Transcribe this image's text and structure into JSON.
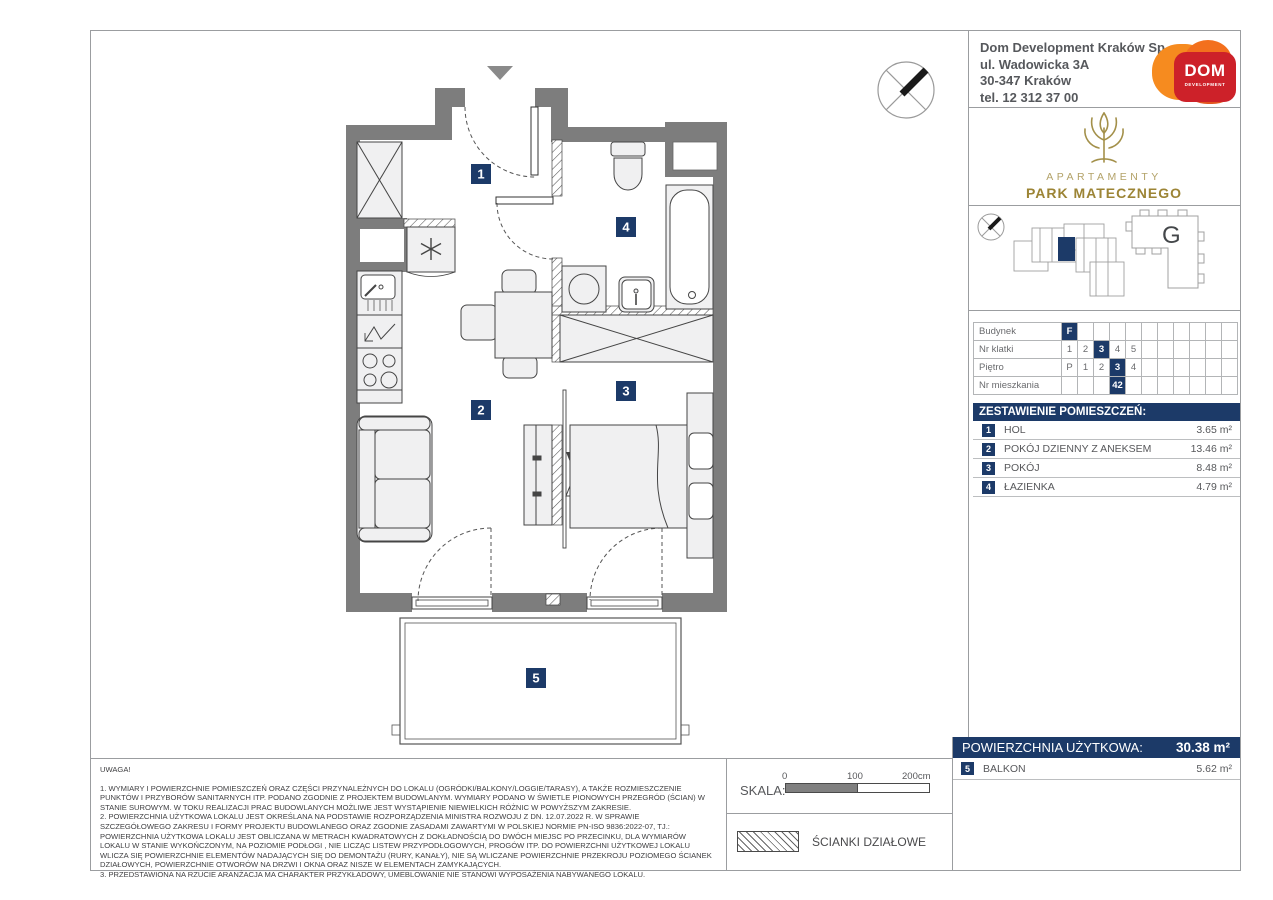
{
  "header": {
    "company": {
      "lines": [
        "Dom Development Kraków Sp. z o.o.",
        "ul. Wadowicka 3A",
        "30-347 Kraków",
        "tel. 12 312 37 00"
      ]
    },
    "dom_logo": {
      "title": "DOM",
      "subtitle": "DEVELOPMENT"
    },
    "brand": {
      "line1": "APARTAMENTY",
      "line2": "PARK MATECZNEGO"
    }
  },
  "site": {
    "building_label": "G"
  },
  "unit_table": {
    "rows": [
      {
        "label": "Budynek",
        "cells": [
          "F",
          "",
          "",
          "",
          "",
          "",
          "",
          "",
          "",
          "",
          ""
        ]
      },
      {
        "label": "Nr klatki",
        "cells": [
          "1",
          "2",
          "3",
          "4",
          "5",
          "",
          "",
          "",
          "",
          "",
          ""
        ]
      },
      {
        "label": "Piętro",
        "cells": [
          "P",
          "1",
          "2",
          "3",
          "4",
          "",
          "",
          "",
          "",
          "",
          ""
        ]
      },
      {
        "label": "Nr mieszkania",
        "cells": [
          "",
          "",
          "",
          "42",
          "",
          "",
          "",
          "",
          "",
          "",
          ""
        ]
      }
    ]
  },
  "rooms": {
    "header": "ZESTAWIENIE POMIESZCZEŃ:",
    "rows": [
      {
        "id": "1",
        "name": "HOL",
        "area": "3.65 m²"
      },
      {
        "id": "2",
        "name": "POKÓJ DZIENNY Z ANEKSEM",
        "area": "13.46 m²"
      },
      {
        "id": "3",
        "name": "POKÓJ",
        "area": "8.48 m²"
      },
      {
        "id": "4",
        "name": "ŁAZIENKA",
        "area": "4.79 m²"
      }
    ]
  },
  "summary": {
    "label": "POWIERZCHNIA UŻYTKOWA:",
    "value": "30.38 m²",
    "balcony": {
      "id": "5",
      "name": "BALKON",
      "area": "5.62 m²"
    }
  },
  "plan": {
    "labels": {
      "hol": "1",
      "living": "2",
      "room": "3",
      "bath": "4",
      "balcony": "5"
    }
  },
  "notes": {
    "title": "UWAGA!",
    "items": [
      "1. WYMIARY I POWIERZCHNIE POMIESZCZEŃ ORAZ CZĘŚCI PRZYNALEŻNYCH DO LOKALU (OGRÓDKI/BALKONY/LOGGIE/TARASY), A TAKŻE ROZMIESZCZENIE PUNKTÓW I PRZYBORÓW SANITARNYCH ITP. PODANO ZGODNIE Z PROJEKTEM BUDOWLANYM. WYMIARY PODANO W ŚWIETLE PIONOWYCH PRZEGRÓD (ŚCIAN) W STANIE SUROWYM. W TOKU REALIZACJI PRAC BUDOWLANYCH MOŻLIWE JEST WYSTĄPIENIE NIEWIELKICH RÓŻNIC W POWYŻSZYM ZAKRESIE.",
      "2. POWIERZCHNIA UŻYTKOWA LOKALU JEST OKREŚLANA NA PODSTAWIE ROZPORZĄDZENIA MINISTRA ROZWOJU Z DN. 12.07.2022 R. W SPRAWIE SZCZEGÓŁOWEGO ZAKRESU I FORMY PROJEKTU BUDOWLANEGO ORAZ ZGODNIE ZASADAMI ZAWARTYMI W POLSKIEJ NORMIE PN-ISO 9836:2022-07, TJ.: POWIERZCHNIA UŻYTKOWA LOKALU JEST OBLICZANA W METRACH KWADRATOWYCH Z DOKŁADNOŚCIĄ DO DWÓCH MIEJSC PO PRZECINKU, DLA WYMIARÓW LOKALU W STANIE WYKOŃCZONYM, NA POZIOMIE PODŁOGI , NIE LICZĄC LISTEW PRZYPODŁOGOWYCH, PROGÓW ITP. DO POWIERZCHNI UŻYTKOWEJ LOKALU WLICZA SIĘ POWIERZCHNIE ELEMENTÓW NADAJĄCYCH SIĘ DO DEMONTAŻU (RURY, KANAŁY), NIE SĄ WLICZANE POWIERZCHNIE PRZEKROJU POZIOMEGO ŚCIANEK DZIAŁOWYCH, POWIERZCHNIE OTWORÓW NA DRZWI I OKNA ORAZ NISZE W ELEMENTACH ZAMYKAJĄCYCH.",
      "3. PRZEDSTAWIONA NA RZUCIE ARANŻACJA MA CHARAKTER PRZYKŁADOWY, UMEBLOWANIE NIE STANOWI WYPOSAŻENIA NABYWANEGO LOKALU."
    ]
  },
  "scale": {
    "label": "SKALA:",
    "ticks": [
      "0",
      "100",
      "200cm"
    ]
  },
  "legend": {
    "partition": "ŚCIANKI DZIAŁOWE"
  },
  "colors": {
    "navy": "#1c3a68",
    "wall": "#7d7d7d",
    "accent_red": "#cd2129",
    "accent_orange": "#f68b1f",
    "gold": "#a3904a"
  }
}
